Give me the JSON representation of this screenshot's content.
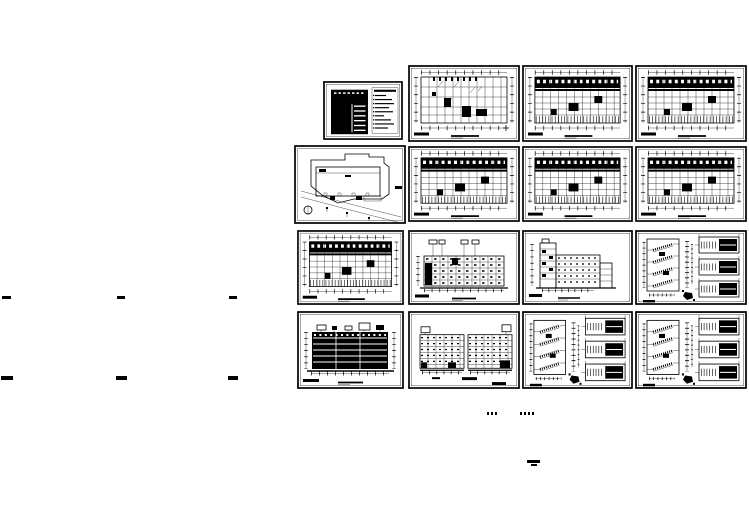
{
  "page": {
    "width": 749,
    "height": 530,
    "background_color": "#ffffff",
    "ink_color": "#000000",
    "kind": "black-and-white architectural CAD drawing set laid out as tiled sheets on a white canvas"
  },
  "sheets": [
    {
      "name": "drawing-index-table",
      "type": "schedule",
      "x": 323,
      "y": 81,
      "w": 80,
      "h": 59
    },
    {
      "name": "floor-plan-a",
      "type": "plan-sparse",
      "x": 408,
      "y": 65,
      "w": 112,
      "h": 77
    },
    {
      "name": "floor-plan-b",
      "type": "plan-dense",
      "x": 522,
      "y": 65,
      "w": 111,
      "h": 77
    },
    {
      "name": "floor-plan-c",
      "type": "plan-dense",
      "x": 635,
      "y": 65,
      "w": 112,
      "h": 77
    },
    {
      "name": "site-plan",
      "type": "site",
      "x": 294,
      "y": 145,
      "w": 112,
      "h": 79
    },
    {
      "name": "floor-plan-d",
      "type": "plan-dense",
      "x": 408,
      "y": 146,
      "w": 112,
      "h": 76
    },
    {
      "name": "floor-plan-e",
      "type": "plan-dense",
      "x": 522,
      "y": 146,
      "w": 111,
      "h": 76
    },
    {
      "name": "floor-plan-f",
      "type": "plan-dense",
      "x": 635,
      "y": 146,
      "w": 112,
      "h": 76
    },
    {
      "name": "floor-plan-g",
      "type": "plan-dense",
      "x": 297,
      "y": 230,
      "w": 107,
      "h": 75
    },
    {
      "name": "elevation-a",
      "type": "elev-light",
      "x": 408,
      "y": 230,
      "w": 112,
      "h": 75
    },
    {
      "name": "elevation-side",
      "type": "elev-side",
      "x": 522,
      "y": 230,
      "w": 111,
      "h": 75
    },
    {
      "name": "stair-detail-a",
      "type": "stair",
      "x": 635,
      "y": 230,
      "w": 112,
      "h": 75
    },
    {
      "name": "elevation-b",
      "type": "elev-dark",
      "x": 297,
      "y": 311,
      "w": 107,
      "h": 78
    },
    {
      "name": "elevation-c",
      "type": "elev-twopart",
      "x": 408,
      "y": 311,
      "w": 112,
      "h": 78
    },
    {
      "name": "stair-detail-b",
      "type": "stair",
      "x": 522,
      "y": 311,
      "w": 111,
      "h": 78
    },
    {
      "name": "stair-detail-c",
      "type": "stair",
      "x": 635,
      "y": 311,
      "w": 112,
      "h": 78
    }
  ],
  "marks": [
    {
      "name": "caption-dash-1",
      "x": 2,
      "y": 296,
      "w": 9,
      "h": 3,
      "style": "solid"
    },
    {
      "name": "caption-dash-2",
      "x": 117,
      "y": 296,
      "w": 8,
      "h": 3,
      "style": "solid"
    },
    {
      "name": "caption-dash-3",
      "x": 229,
      "y": 296,
      "w": 8,
      "h": 3,
      "style": "solid"
    },
    {
      "name": "caption-text-1",
      "x": 1,
      "y": 376,
      "w": 12,
      "h": 4,
      "style": "solid"
    },
    {
      "name": "caption-text-2",
      "x": 116,
      "y": 376,
      "w": 11,
      "h": 4,
      "style": "solid"
    },
    {
      "name": "caption-text-3",
      "x": 228,
      "y": 376,
      "w": 10,
      "h": 4,
      "style": "solid"
    },
    {
      "name": "caption-dots-1",
      "x": 487,
      "y": 412,
      "w": 11,
      "h": 3,
      "style": "dots"
    },
    {
      "name": "caption-dots-2",
      "x": 520,
      "y": 412,
      "w": 14,
      "h": 3,
      "style": "dots"
    },
    {
      "name": "scale-bar-top",
      "x": 527,
      "y": 460,
      "w": 13,
      "h": 3,
      "style": "solid"
    },
    {
      "name": "scale-bar-bottom",
      "x": 531,
      "y": 464,
      "w": 6,
      "h": 2,
      "style": "solid"
    }
  ]
}
